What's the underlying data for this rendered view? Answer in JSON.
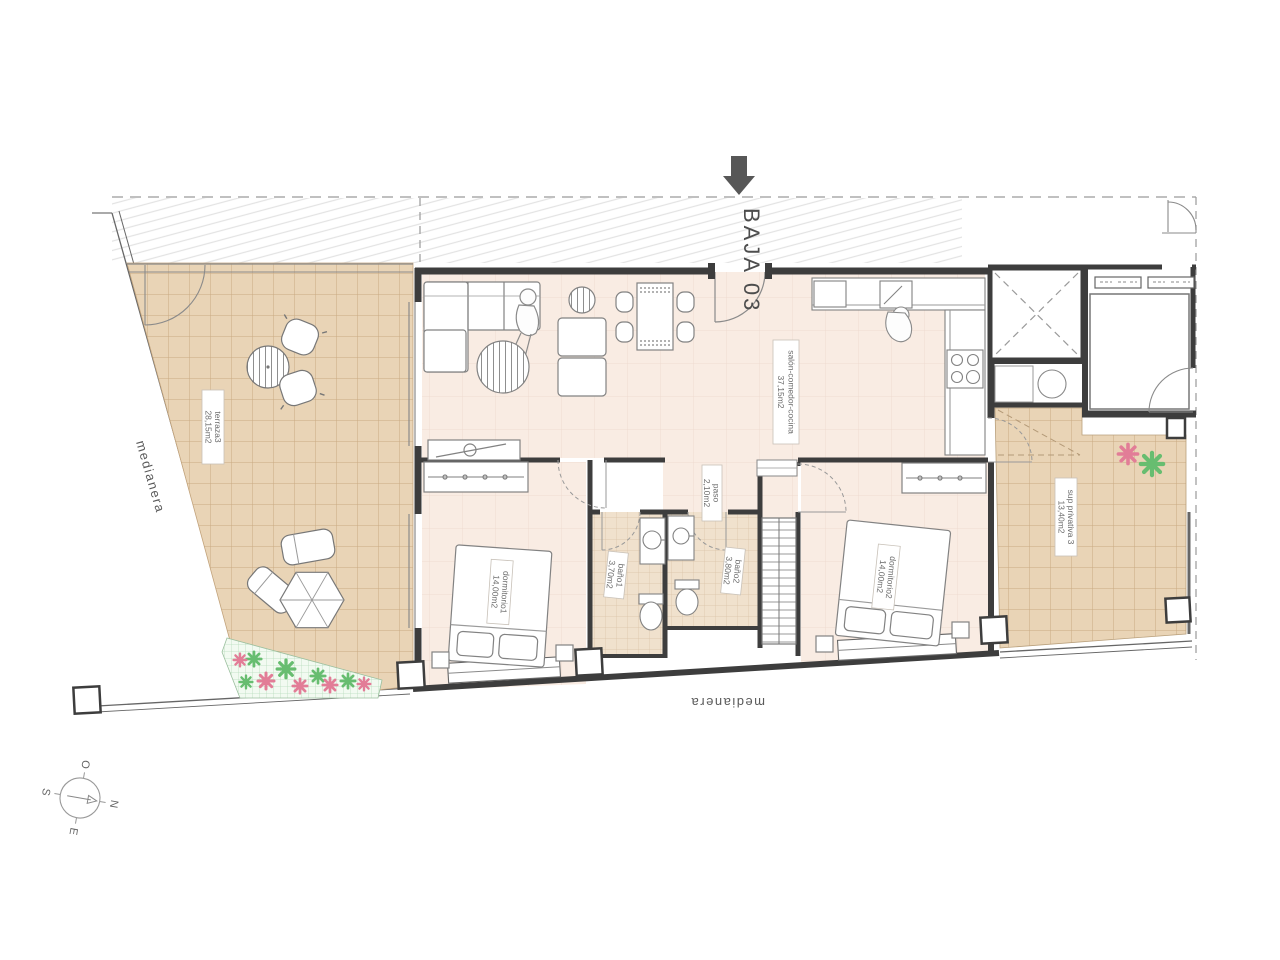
{
  "plan": {
    "title": "BAJA 03"
  },
  "boundaries": {
    "left_label": "medianera",
    "bottom_label": "medianera"
  },
  "compass": {
    "north": "N",
    "south": "S",
    "east": "E",
    "west": "O"
  },
  "rooms": [
    {
      "id": "terraza3",
      "label": "terraza3",
      "area": "28,15m2"
    },
    {
      "id": "salon-comedor-cocina",
      "label": "salón-comedor-cocina",
      "area": "37,15m2"
    },
    {
      "id": "paso",
      "label": "paso",
      "area": "2,10m2"
    },
    {
      "id": "dormitorio1",
      "label": "dormitorio1",
      "area": "14,00m2"
    },
    {
      "id": "bano1",
      "label": "baño1",
      "area": "3,70m2"
    },
    {
      "id": "bano2",
      "label": "baño2",
      "area": "3,80m2"
    },
    {
      "id": "dormitorio2",
      "label": "dormitorio2",
      "area": "14,00m2"
    },
    {
      "id": "sup-privativa-3",
      "label": "sup privativa 3",
      "area": "13,40m2"
    }
  ],
  "colors": {
    "terrace_tile": "#e9d4b6",
    "tile_line": "#c9aa82",
    "interior_floor": "#f9ece3",
    "bath_tile": "#f0e1cd",
    "wall": "#3d3d3d",
    "flower_pink": "#e27d97",
    "flower_green": "#67bd70",
    "arrow": "#575757",
    "plant_bed": "#f2faf1"
  }
}
